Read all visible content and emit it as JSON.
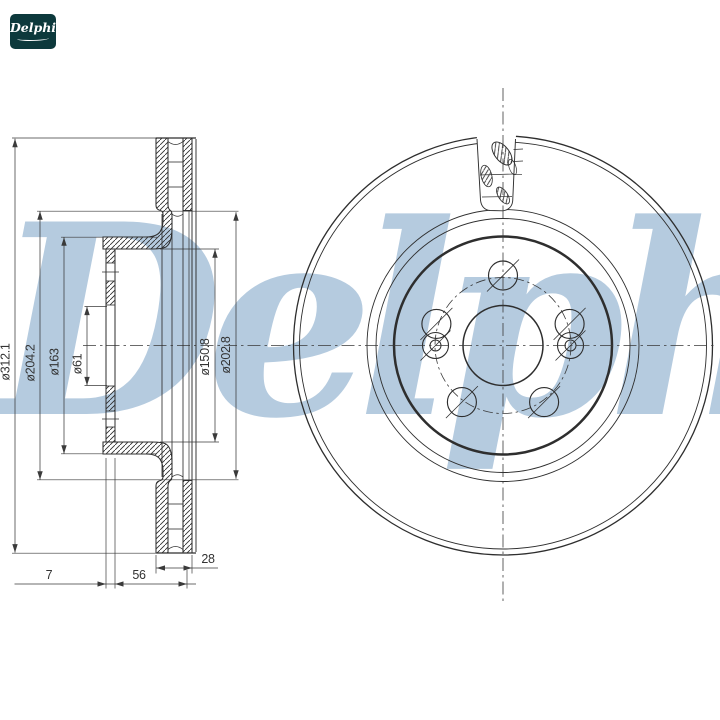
{
  "page": {
    "title": "Brake disc technical drawing",
    "background": "#ffffff"
  },
  "logo": {
    "text": "Delphi",
    "bg_color": "#0d393c",
    "text_color": "#ffffff"
  },
  "watermark": {
    "text": "Delphi",
    "color": "#b5cbdf"
  },
  "drawing": {
    "line_color": "#2e2e2e",
    "section_view": {
      "diameter_dims": [
        {
          "label": "ø312.1"
        },
        {
          "label": "ø204.2"
        },
        {
          "label": "ø163"
        },
        {
          "label": "ø61"
        },
        {
          "label": "ø150.8"
        },
        {
          "label": "ø202.8"
        }
      ],
      "linear_dims": [
        {
          "label": "7"
        },
        {
          "label": "56"
        },
        {
          "label": "28"
        }
      ]
    },
    "front_view": {
      "bolt_hole_count": "5",
      "pin_hole_count": "2"
    }
  }
}
